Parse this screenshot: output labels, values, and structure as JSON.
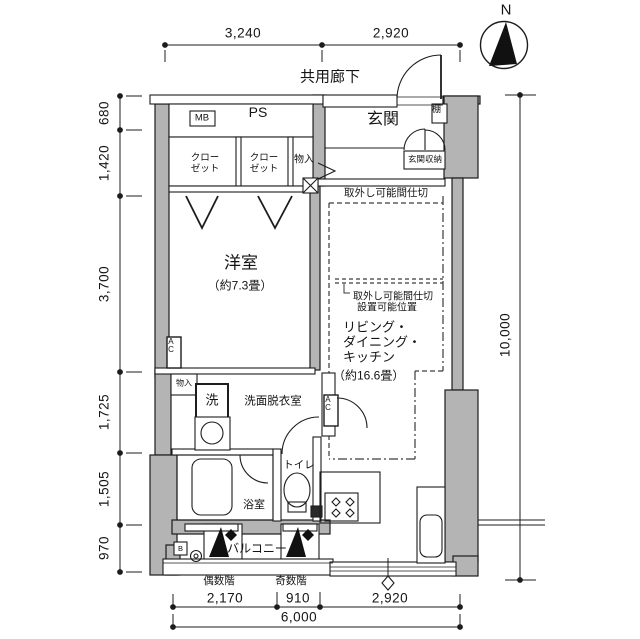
{
  "labels": {
    "corridor": "共用廊下",
    "ps": "PS",
    "mb": "MB",
    "entrance": "玄関",
    "entrance_storage": "玄関収納",
    "shelf": "棚",
    "closet_l1": "クロー",
    "closet_l2": "ゼット",
    "storage_top": "物入",
    "western_name": "洋室",
    "western_size": "（約7.3畳）",
    "partition_removable": "取外し可能間仕切",
    "partition_pos_l1": "取外し可能間仕切",
    "partition_pos_l2": "設置可能位置",
    "ldk_l1": "リビング・",
    "ldk_l2": "ダイニング・",
    "ldk_l3": "キッチン",
    "ldk_size": "（約16.6畳）",
    "washroom": "洗面脱衣室",
    "washer": "洗",
    "storage_small": "物入",
    "bath": "浴室",
    "toilet": "トイレ",
    "balcony": "バルコニー",
    "even_floor": "偶数階",
    "odd_floor": "奇数階",
    "ac": "AC",
    "b_mark": "B",
    "north": "N"
  },
  "dims": {
    "top": [
      "3,240",
      "2,920"
    ],
    "left": [
      "680",
      "1,420",
      "3,700",
      "1,725",
      "1,505",
      "970"
    ],
    "right": "10,000",
    "bottom": [
      "2,170",
      "910",
      "2,920"
    ],
    "total": "6,000"
  },
  "colors": {
    "wall_fill": "#b4b4b4",
    "line": "#1c1c1c",
    "background": "#ffffff"
  }
}
